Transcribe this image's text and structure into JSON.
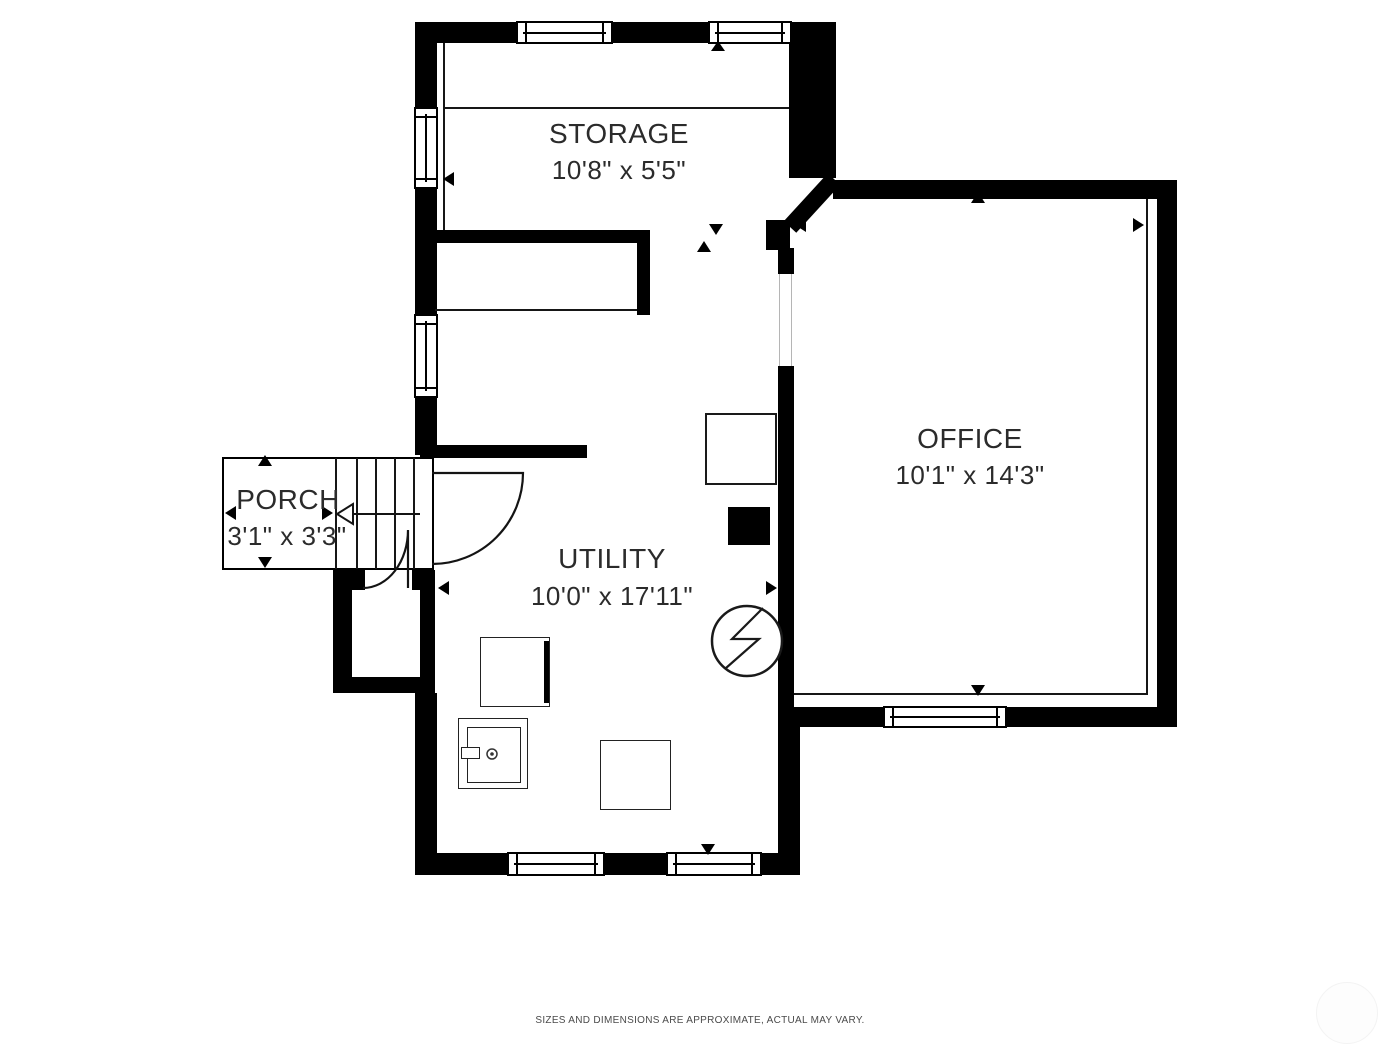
{
  "plan": {
    "title": "floor-plan",
    "rooms": [
      {
        "name": "STORAGE",
        "dimensions": "10'8\" x 5'5\""
      },
      {
        "name": "OFFICE",
        "dimensions": "10'1\" x 14'3\""
      },
      {
        "name": "UTILITY",
        "dimensions": "10'0\" x 17'11\""
      },
      {
        "name": "PORCH",
        "dimensions": "3'1\" x 3'3\""
      }
    ],
    "footer_disclaimer": "SIZES AND DIMENSIONS ARE APPROXIMATE, ACTUAL MAY VARY.",
    "colors": {
      "wall": "#000000",
      "background": "#ffffff",
      "label_text": "#2b2b2b",
      "footer_text": "#4a4a4a"
    },
    "symbols": [
      "window",
      "door-swing",
      "staircase",
      "stair-direction-arrow",
      "electrical-panel",
      "washer",
      "dryer",
      "chimney",
      "dimension-arrow"
    ]
  }
}
